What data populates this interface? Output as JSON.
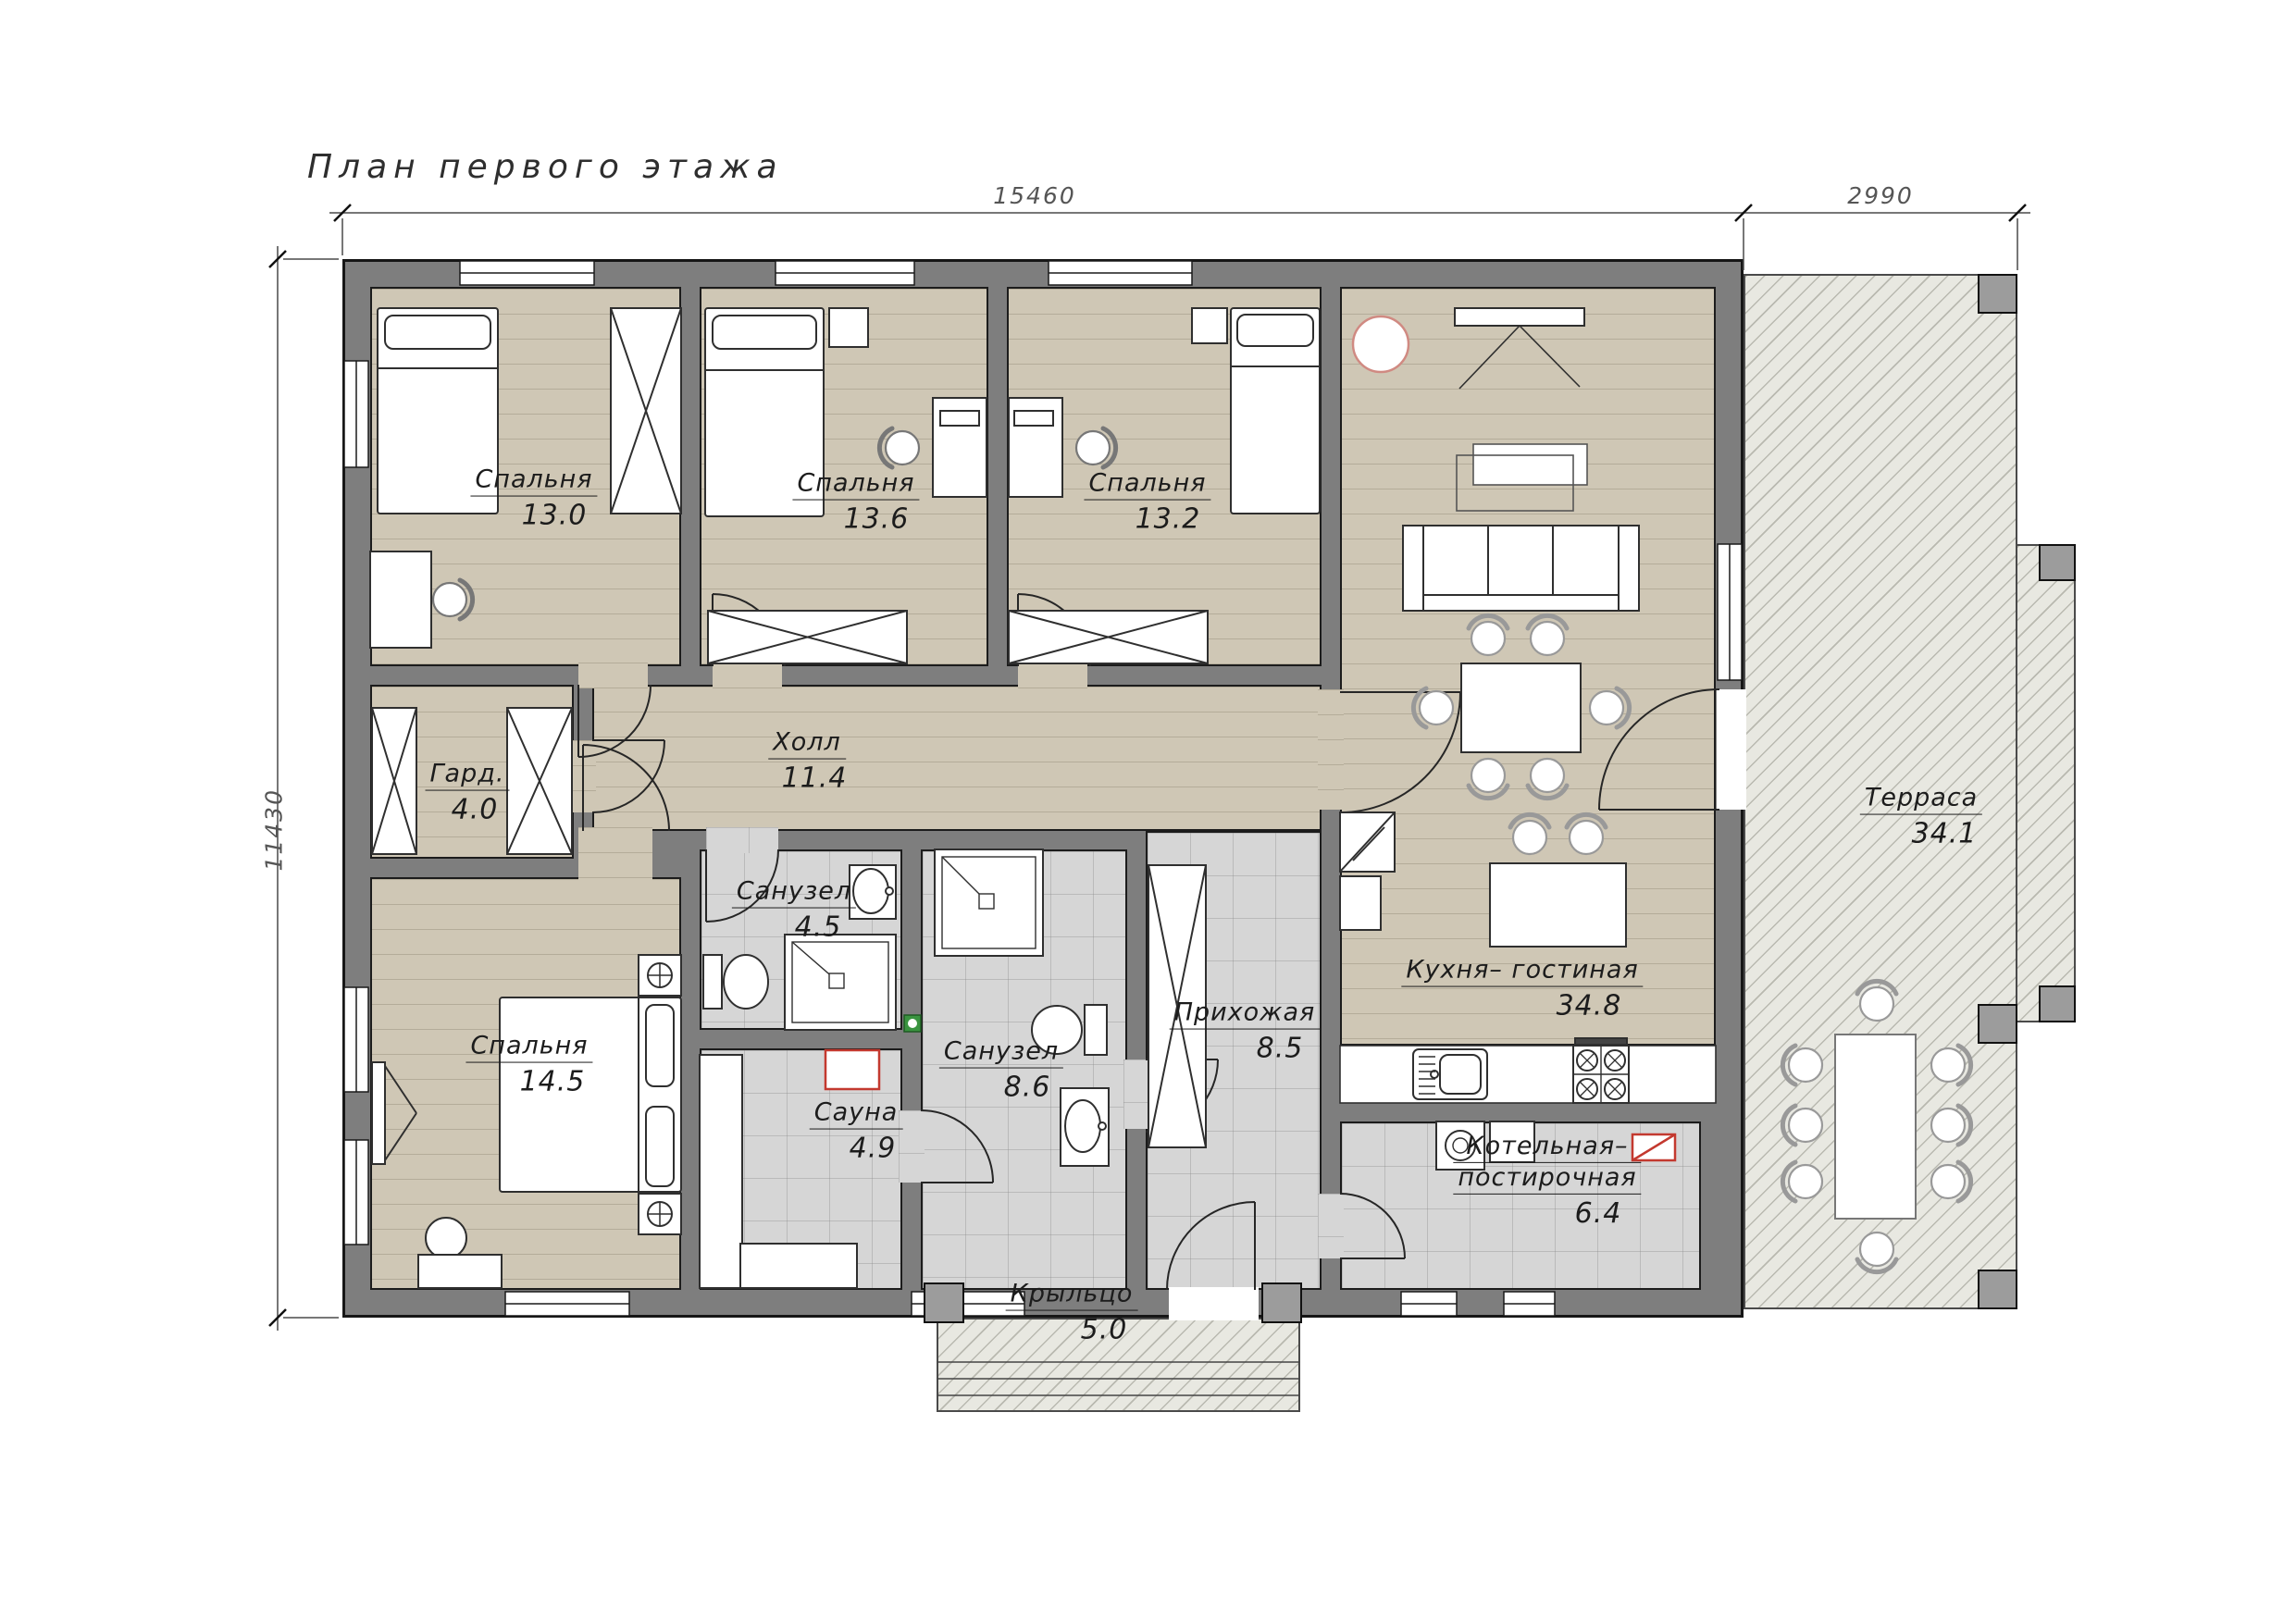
{
  "title": "План первого этажа",
  "dimensions": {
    "width_main_mm": "15460",
    "width_terrace_mm": "2990",
    "height_mm": "11430"
  },
  "rooms": [
    {
      "id": "bedroom-1",
      "name": "Спальня",
      "area": "13.0"
    },
    {
      "id": "bedroom-2",
      "name": "Спальня",
      "area": "13.6"
    },
    {
      "id": "bedroom-3",
      "name": "Спальня",
      "area": "13.2"
    },
    {
      "id": "kitchen-living",
      "name": "Кухня– гостиная",
      "area": "34.8"
    },
    {
      "id": "hall",
      "name": "Холл",
      "area": "11.4"
    },
    {
      "id": "wardrobe",
      "name": "Гард.",
      "area": "4.0"
    },
    {
      "id": "bathroom-small",
      "name": "Санузел",
      "area": "4.5"
    },
    {
      "id": "bathroom-big",
      "name": "Санузел",
      "area": "8.6"
    },
    {
      "id": "sauna",
      "name": "Сауна",
      "area": "4.9"
    },
    {
      "id": "bedroom-4",
      "name": "Спальня",
      "area": "14.5"
    },
    {
      "id": "entry-hall",
      "name": "Прихожая",
      "area": "8.5"
    },
    {
      "id": "boiler-laundry",
      "name_line1": "Котельная–",
      "name_line2": "постирочная",
      "area": "6.4"
    },
    {
      "id": "terrace",
      "name": "Терраса",
      "area": "34.1"
    },
    {
      "id": "porch",
      "name": "Крыльцо",
      "area": "5.0"
    }
  ],
  "colors": {
    "wall": "#7e7e7e",
    "floor_wood": "#cfc7b5",
    "floor_tile": "#d6d6d6",
    "outdoor_hatch": "#e8e8e1",
    "accent_red": "#c3392f",
    "accent_green": "#3a9440"
  }
}
